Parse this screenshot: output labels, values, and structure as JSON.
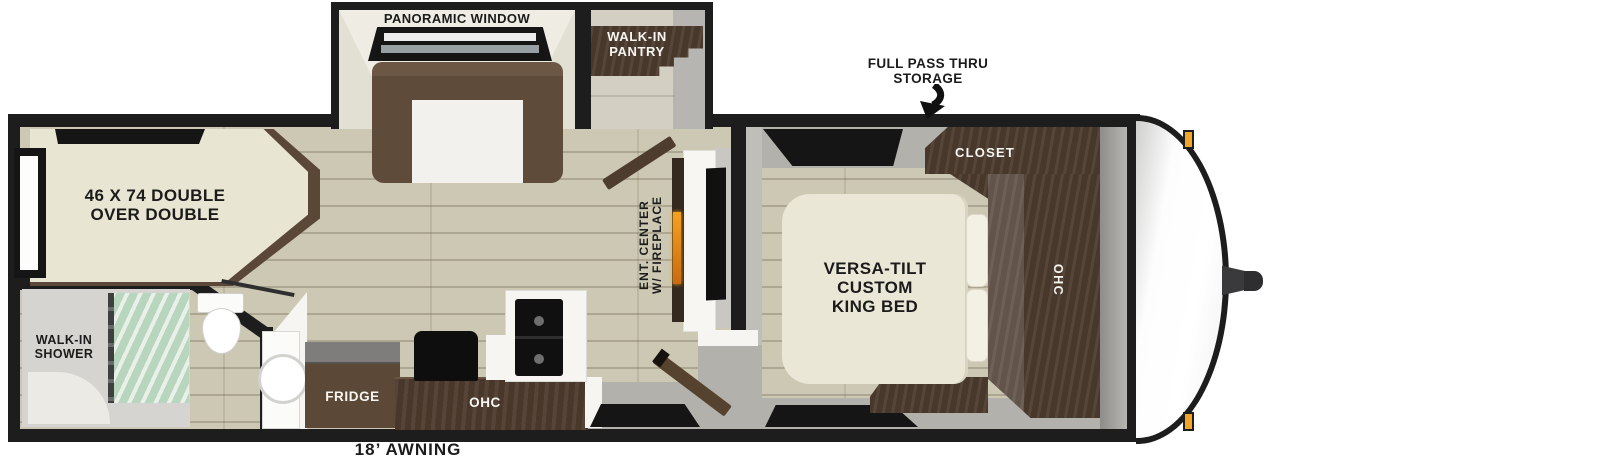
{
  "labels": {
    "panoramic_window": "PANORAMIC WINDOW",
    "pantry_line1": "WALK-IN",
    "pantry_line2": "PANTRY",
    "storage_line1": "FULL PASS THRU",
    "storage_line2": "STORAGE",
    "bunk_line1": "46 X 74 DOUBLE",
    "bunk_line2": "OVER DOUBLE",
    "shower_line1": "WALK-IN",
    "shower_line2": "SHOWER",
    "fridge": "FRIDGE",
    "kitchen_ohc": "OHC",
    "ent_line1": "ENT. CENTER",
    "ent_line2": "W/ FIREPLACE",
    "king_line1": "VERSA-TILT",
    "king_line2": "CUSTOM",
    "king_line3": "KING BED",
    "closet": "CLOSET",
    "bedroom_ohc": "OHC",
    "awning": "18’ AWNING"
  },
  "colors": {
    "wall": "#1d1d1d",
    "wood_floor": "#cdc8b3",
    "dark_cabinet": "#4c3b2e",
    "sofa_brown": "#5f4b39",
    "bed_cream": "#eae6d5",
    "floor_gray": "#b3b1ab",
    "fireplace_glow": "#ef9c1e",
    "marker_light": "#f2a52b",
    "shower_glass": "#bcd8c2"
  }
}
